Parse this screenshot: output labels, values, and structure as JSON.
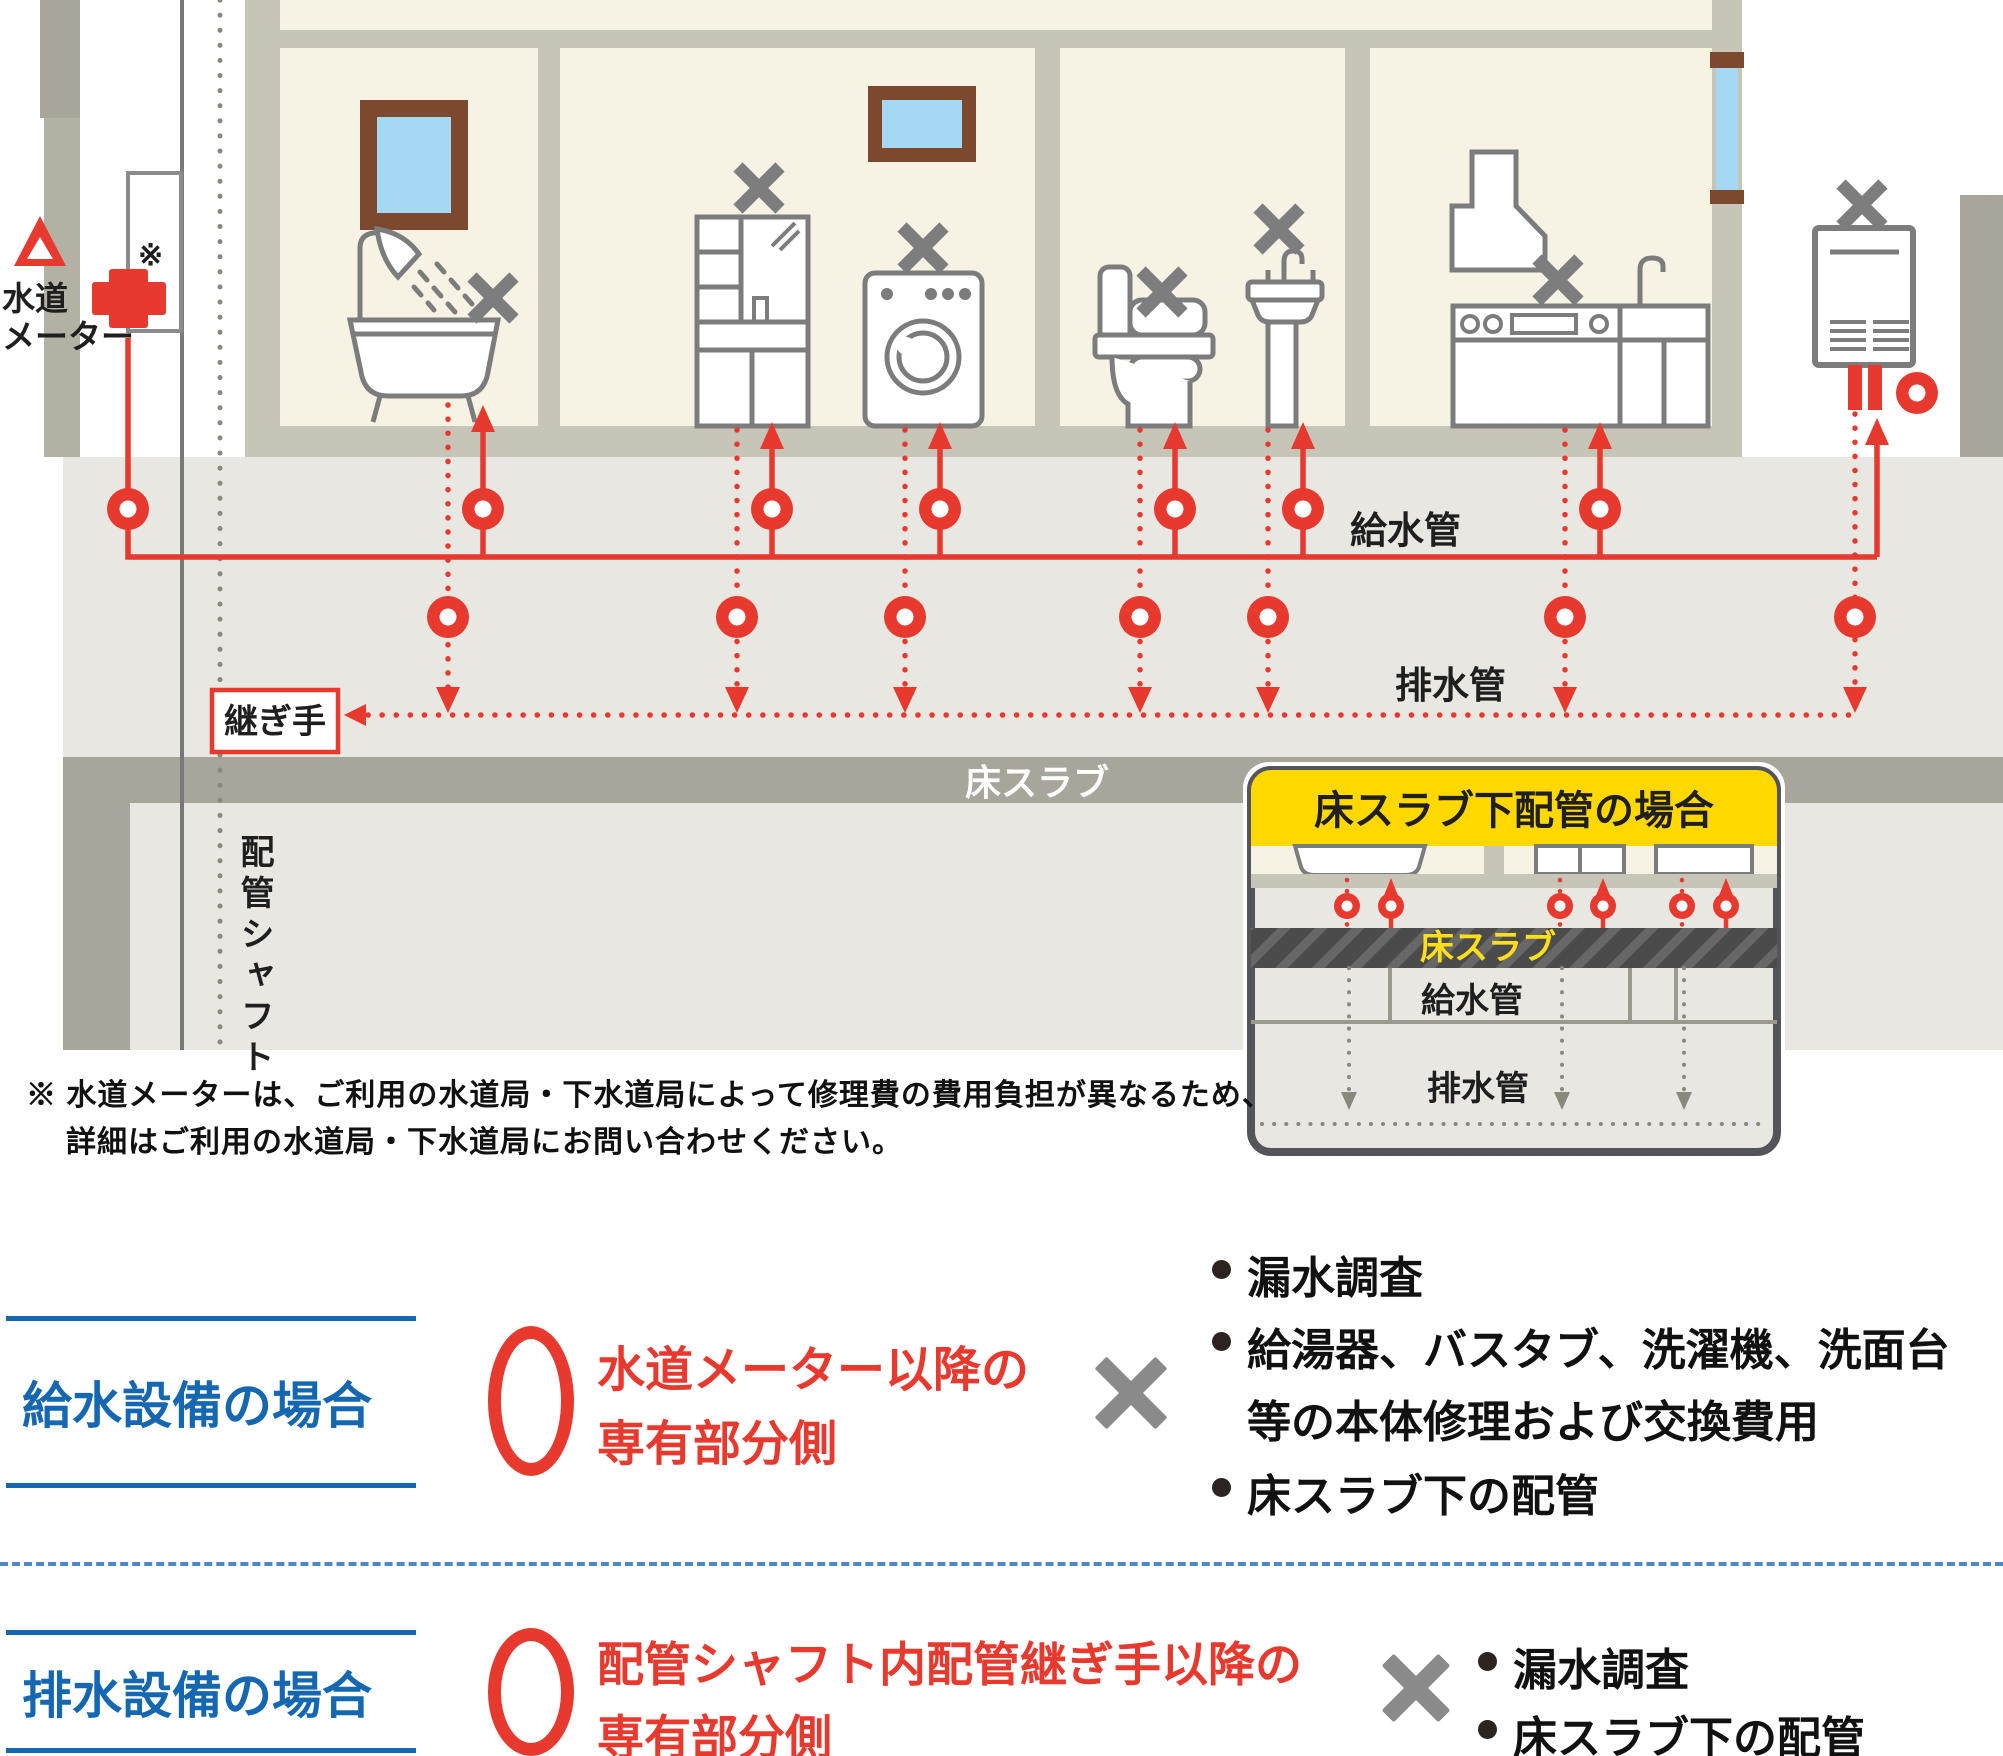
{
  "colors": {
    "pipe_red": "#e8392e",
    "excluded_gray": "#8a8a8a",
    "heading_blue": "#1667b2",
    "inset_header_yellow": "#ffd800",
    "slab_gray": "#a8a69a",
    "room_beige": "#f6f3e5",
    "window_blue": "#a5d8f3",
    "frame_brown": "#7c492e"
  },
  "diagram": {
    "water_meter_label_line1": "水道",
    "water_meter_label_line2": "メーター",
    "note_mark": "※",
    "supply_pipe_label": "給水管",
    "drain_pipe_label": "排水管",
    "joint_label": "継ぎ手",
    "floor_slab_label": "床スラブ",
    "pipe_shaft_label": "配管シャフト",
    "inset": {
      "title": "床スラブ下配管の場合",
      "floor_slab_label": "床スラブ",
      "supply_pipe_label": "給水管",
      "drain_pipe_label": "排水管"
    }
  },
  "footnote": {
    "line1": "※ 水道メーターは、ご利用の水道局・下水道局によって修理費の費用負担が異なるため、",
    "line2": "詳細はご利用の水道局・下水道局にお問い合わせください。"
  },
  "legend": {
    "supply": {
      "title": "給水設備の場合",
      "covered_line1": "水道メーター以降の",
      "covered_line2": "専有部分側",
      "excluded": [
        {
          "text": "漏水調査"
        },
        {
          "text": "給湯器、バスタブ、洗濯機、洗面台"
        },
        {
          "text": "等の本体修理および交換費用"
        },
        {
          "text": "床スラブ下の配管"
        }
      ]
    },
    "drain": {
      "title": "排水設備の場合",
      "covered_line1": "配管シャフト内配管継ぎ手以降の",
      "covered_line2": "専有部分側",
      "excluded": [
        {
          "text": "漏水調査"
        },
        {
          "text": "床スラブ下の配管"
        }
      ]
    }
  }
}
